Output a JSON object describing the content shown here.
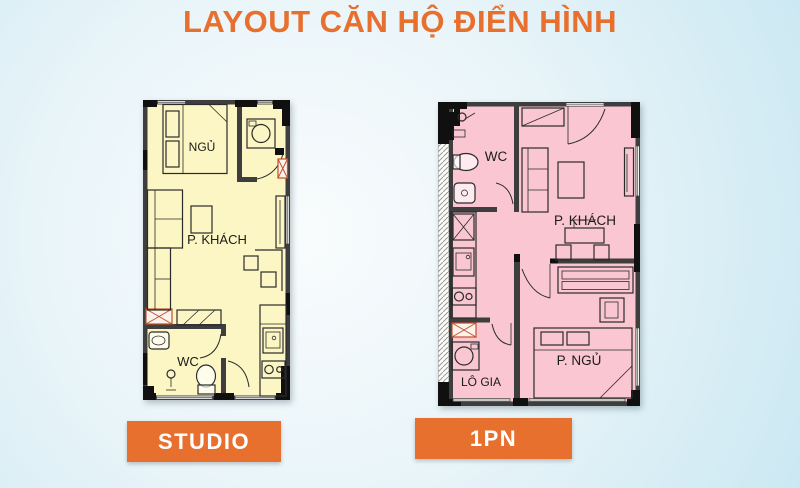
{
  "title": "LAYOUT CĂN HỘ ĐIỂN HÌNH",
  "colors": {
    "accent": "#E7702E",
    "studio_floor": "#FBF6C3",
    "onebed_floor": "#F9C6D2",
    "wall": "#3E3E3E",
    "background_edge": "#CBE8F2",
    "background_center": "#F9FCFD"
  },
  "plans": [
    {
      "name": "Studio apartment",
      "button_label": "STUDIO",
      "rooms": {
        "bedroom": "NGỦ",
        "living": "P. KHÁCH",
        "wc": "WC"
      }
    },
    {
      "name": "One-bedroom apartment",
      "button_label": "1PN",
      "rooms": {
        "wc": "WC",
        "living": "P. KHÁCH",
        "bedroom": "P. NGỦ",
        "loggia": "LÔ GIA"
      }
    }
  ]
}
